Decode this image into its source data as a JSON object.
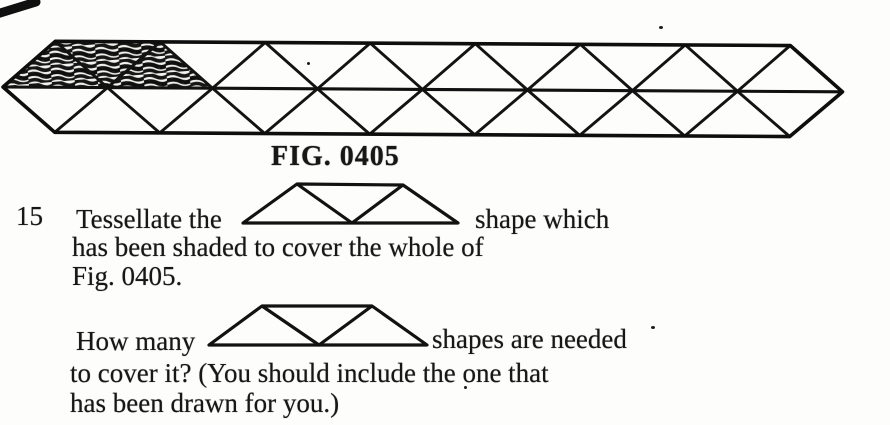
{
  "page": {
    "background": "#fdfdfb",
    "ink": "#171717"
  },
  "figure": {
    "caption": "FIG. 0405",
    "rows": 2,
    "triangles_per_row": 15,
    "shaded_triangles": 3,
    "shaded_region": "trapezium of three triangles at top-left of strip"
  },
  "question": {
    "number": "15",
    "tessellate_before_shape": "Tessellate the",
    "tessellate_after_shape": "shape which",
    "tessellate_line2": "has been shaded to cover the whole of",
    "tessellate_line3": "Fig. 0405.",
    "howmany_before_shape": "How many",
    "howmany_after_shape": "shapes are needed",
    "howmany_line2": "to cover it? (You should include the one that",
    "howmany_line3": "has been drawn for you.)"
  }
}
